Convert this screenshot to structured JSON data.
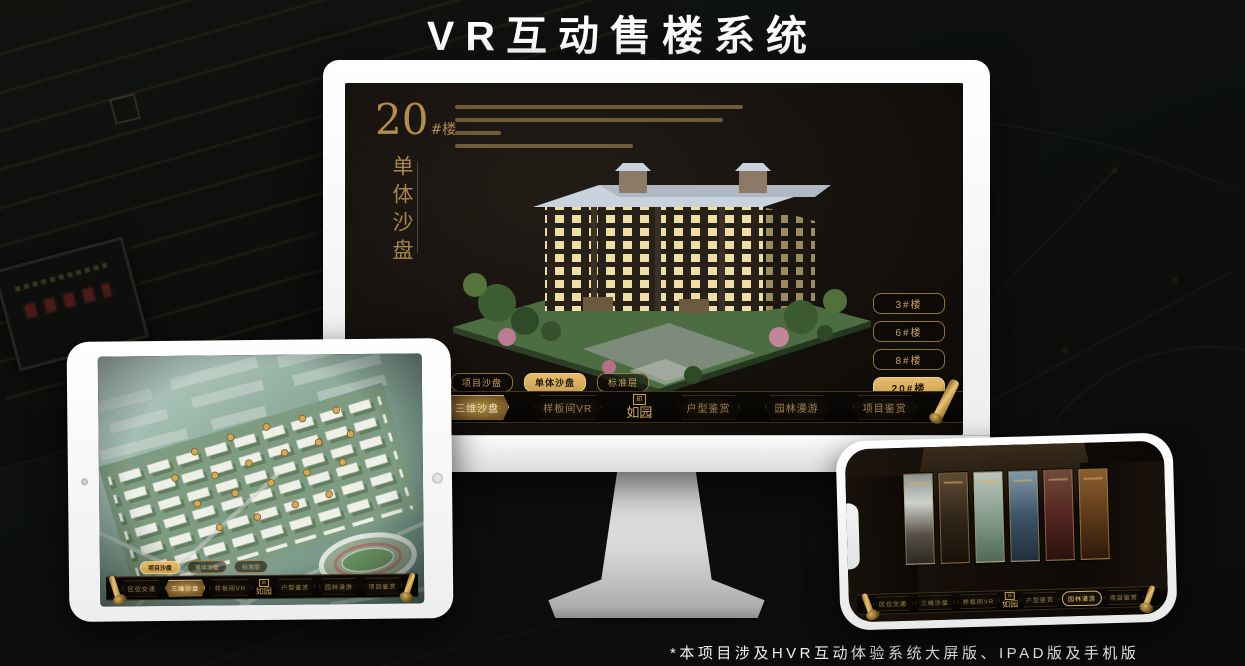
{
  "page": {
    "title": "VR互动售楼系统",
    "footnote": "*本项目涉及HVR互动体验系统大屏版、IPAD版及手机版"
  },
  "brand": {
    "logo_text": "如园",
    "logo_seal": "印",
    "gold": "#c9a05a",
    "gold_bright": "#e7bd6d"
  },
  "app_nav": {
    "items": [
      {
        "label": "区位交通"
      },
      {
        "label": "三维沙盘"
      },
      {
        "label": "样板间VR"
      },
      {
        "label": "户型鉴赏"
      },
      {
        "label": "园林漫游"
      },
      {
        "label": "项目鉴赏"
      }
    ]
  },
  "monitor": {
    "heading": {
      "number": "20",
      "suffix": "#楼",
      "subtitle": "单体沙盘"
    },
    "floor_buttons": [
      {
        "label": "3#楼",
        "selected": false
      },
      {
        "label": "6#楼",
        "selected": false
      },
      {
        "label": "8#楼",
        "selected": false
      },
      {
        "label": "20#楼",
        "selected": true
      }
    ],
    "sub_tabs": [
      {
        "label": "项目沙盘",
        "active": false
      },
      {
        "label": "单体沙盘",
        "active": true
      },
      {
        "label": "标准层",
        "active": false
      }
    ],
    "active_nav": "三维沙盘"
  },
  "ipad": {
    "sub_tabs": [
      {
        "label": "项目沙盘",
        "active": true
      },
      {
        "label": "单体沙盘",
        "active": false
      },
      {
        "label": "标准层",
        "active": false
      }
    ],
    "active_nav": "三维沙盘"
  },
  "phone": {
    "active_nav": "园林漫游"
  }
}
